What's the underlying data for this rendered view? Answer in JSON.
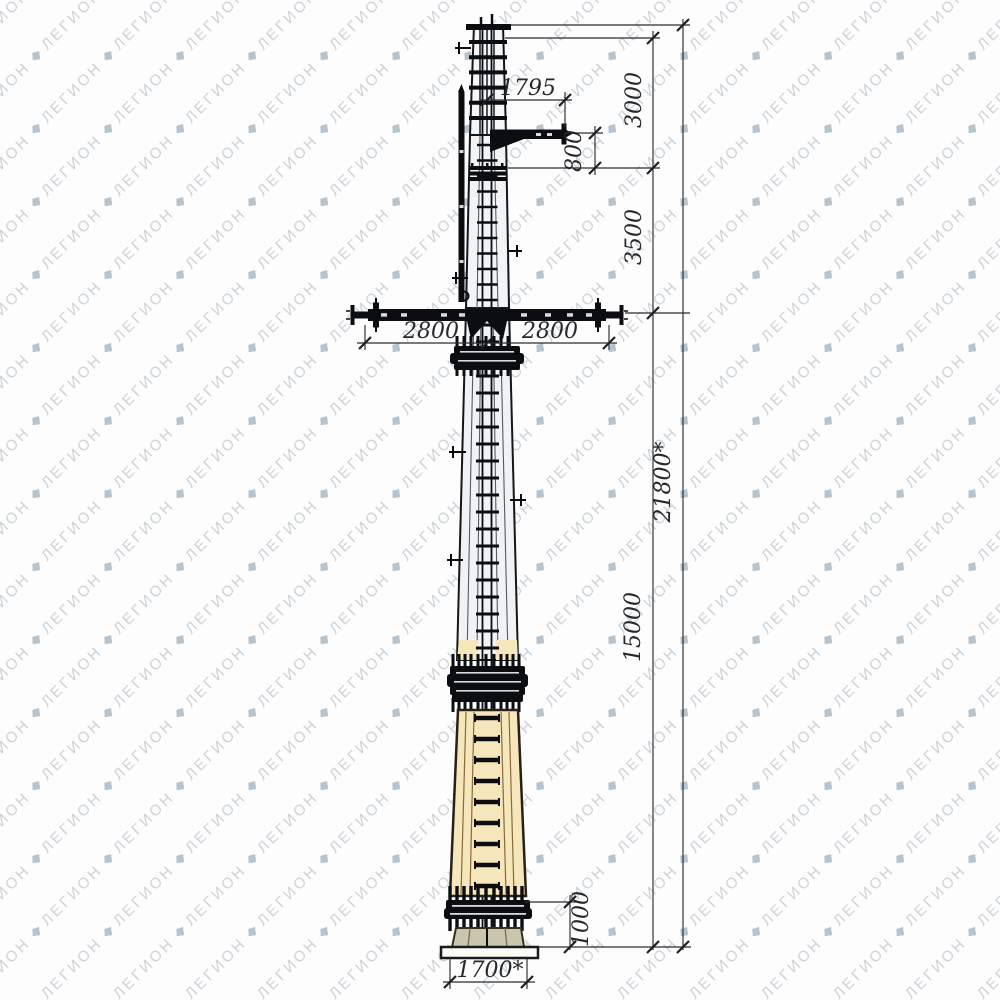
{
  "watermark": {
    "text": "ЛЕГИОН",
    "color": "#94a3b0",
    "logo": "legion-diamond-icon"
  },
  "drawing": {
    "type": "technical-elevation",
    "subject": "steel multifaceted transmission pole, front elevation with dimension chains",
    "dims": {
      "arm_length": "1795",
      "top_section_height": "3000",
      "arm_vertical_offset": "800",
      "upper_section_height": "3500",
      "crossarm_left_half": "2800",
      "crossarm_right_half": "2800",
      "crossarm_height": "15000",
      "total_height": "21800*",
      "base_section_height": "1000",
      "base_width": "1700*"
    },
    "colors": {
      "pole_top_fill": "#f4f5f6",
      "pole_upper_fill": "#f2f3f5",
      "pole_mid_fill": "#f0f2f4",
      "pole_lower_fill": "#f6e6bc",
      "base_stub_fill": "#c9c6ab",
      "base_plate_fill": "#fbfbf6",
      "ink": "#0c0d10",
      "dimension": "#26282c"
    }
  }
}
